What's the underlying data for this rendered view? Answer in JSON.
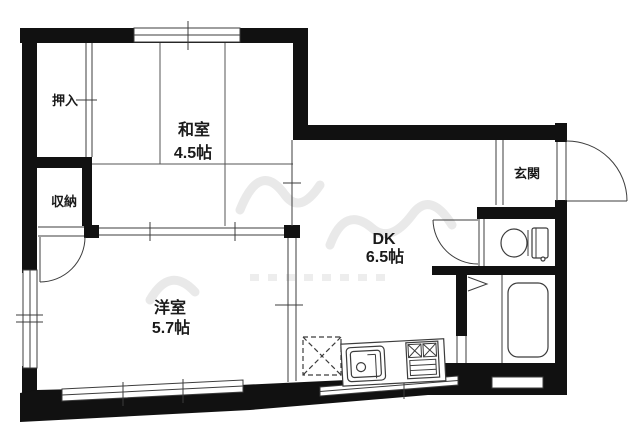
{
  "floorplan": {
    "rooms": {
      "washitsu": {
        "label": "和室",
        "size": "4.5帖"
      },
      "yoshitsu": {
        "label": "洋室",
        "size": "5.7帖"
      },
      "dk": {
        "label": "DK",
        "size": "6.5帖"
      },
      "genkan": {
        "label": "玄関"
      },
      "oshiire": {
        "label": "押入"
      },
      "shuno": {
        "label": "収納"
      }
    },
    "fixtures": {
      "toilet": "toilet-icon",
      "bathtub": "bathtub-icon",
      "kitchen_sink": "kitchen-sink-icon",
      "gas_stove": "gas-stove-icon",
      "refrigerator_space": "refrigerator-space-dashed-box"
    },
    "colors": {
      "wall": "#111111",
      "line": "#3c3c3c",
      "background": "#ffffff",
      "watermark": "#e9e9e9"
    }
  }
}
